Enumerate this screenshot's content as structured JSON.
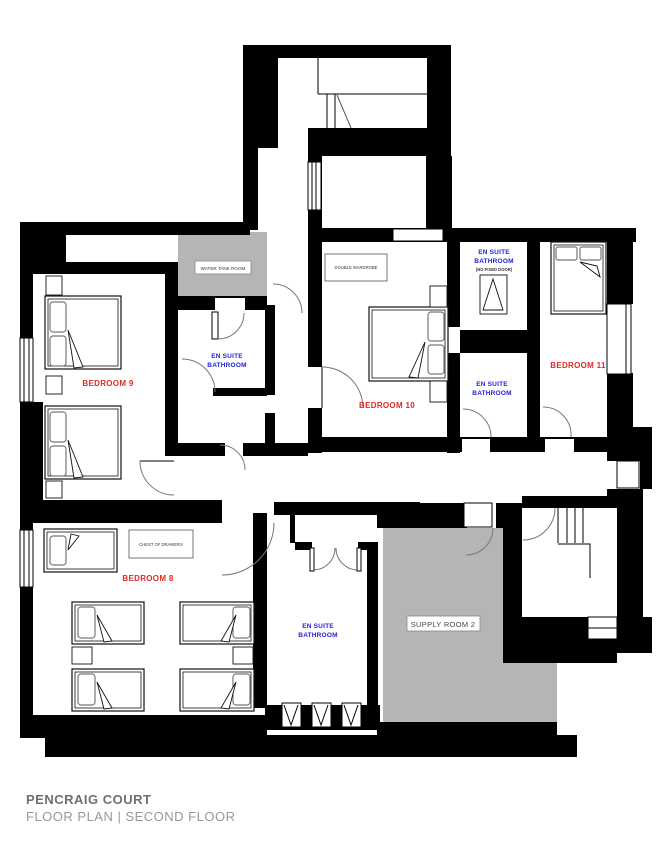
{
  "footer": {
    "title": "PENCRAIG COURT",
    "subtitle": "FLOOR PLAN | SECOND FLOOR"
  },
  "colors": {
    "wall": "#000000",
    "bedroom_label": "#e02a23",
    "bathroom_label": "#1f1fd6",
    "gray_room_fill": "#b5b5b5",
    "door_arc": "#777777"
  },
  "rooms": {
    "bedroom9": {
      "label": "BEDROOM 9"
    },
    "bedroom10": {
      "label": "BEDROOM 10"
    },
    "bedroom11": {
      "label": "BEDROOM 11"
    },
    "bedroom8": {
      "label": "BEDROOM 8"
    },
    "water_tank": {
      "label": "WATER TANK ROOM"
    },
    "supply": {
      "label": "SUPPLY ROOM 2"
    },
    "ensuite9": {
      "line1": "EN SUITE",
      "line2": "BATHROOM"
    },
    "ensuite10": {
      "line1": "EN SUITE",
      "line2": "BATHROOM",
      "line3": "(NO FIXED DOOR)"
    },
    "ensuite11": {
      "line1": "EN SUITE",
      "line2": "BATHROOM"
    },
    "ensuite8": {
      "line1": "EN SUITE",
      "line2": "BATHROOM"
    }
  },
  "furniture": {
    "wardrobe": "DOUBLE WARDROBE",
    "chest": "CHEST OF DRAWERS"
  }
}
